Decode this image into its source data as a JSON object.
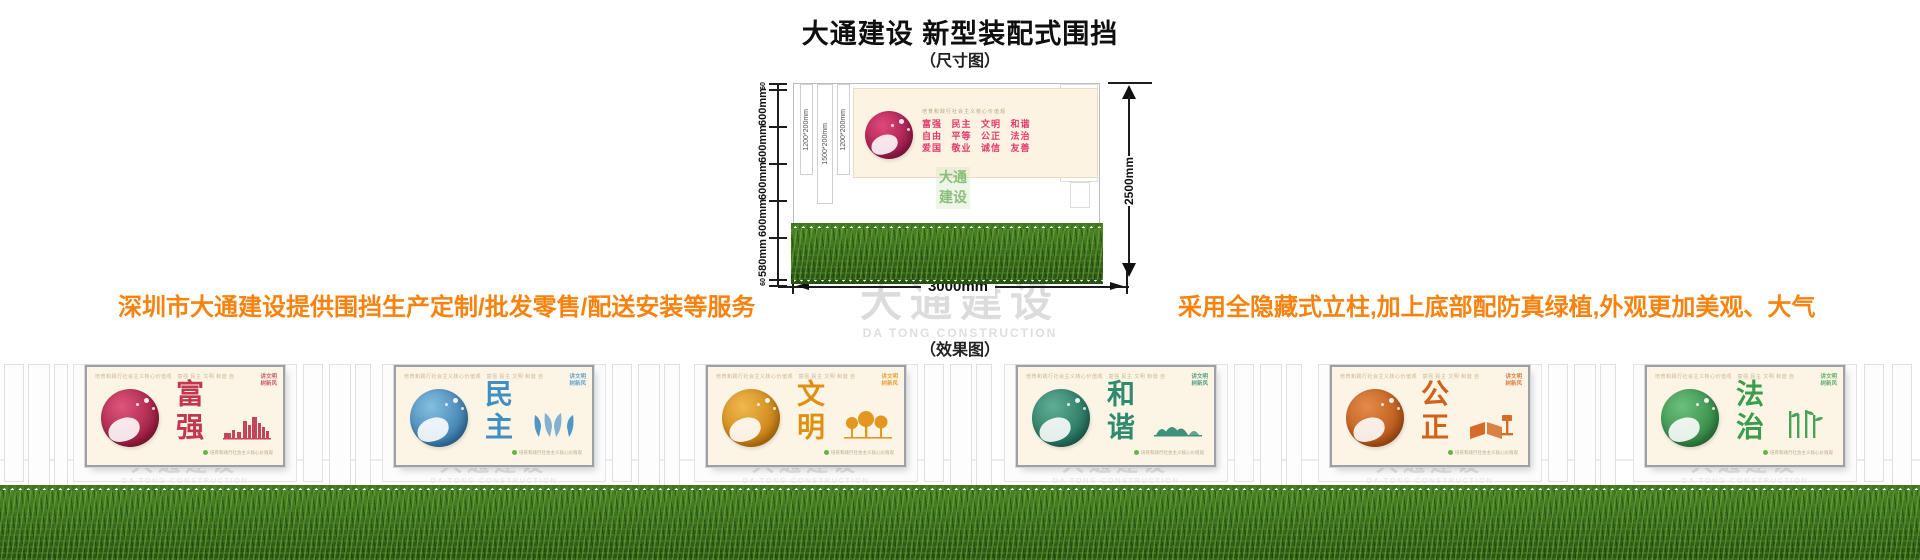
{
  "page": {
    "title": "大通建设 新型装配式围挡",
    "size_label": "（尺寸图）",
    "effect_label": "（效果图）"
  },
  "notes": {
    "left": "深圳市大通建设提供围挡生产定制/批发零售/配送安装等服务",
    "right": "采用全隐藏式立柱,加上底部配防真绿植,外观更加美观、大气",
    "color": "#f8820e"
  },
  "diagram": {
    "post_labels": [
      "1200*200mm",
      "1500*200mm",
      "1200*200mm"
    ],
    "left_dims": [
      "60",
      "600mm",
      "600mm",
      "600mm",
      "600mm",
      "580mm",
      "60"
    ],
    "right_dim": "2500mm",
    "bottom_dim": "3000mm",
    "billboard": {
      "header": "培育和践行社会主义核心价值观",
      "lines": [
        "富强  民主  文明  和谐",
        "自由  平等  公正  法治",
        "爱国  敬业  诚信  友善"
      ],
      "logo_lines": [
        "大通",
        "建设"
      ]
    }
  },
  "watermark": {
    "cn": "大通建设",
    "en": "DA TONG CONSTRUCTION"
  },
  "panel_common": {
    "header": "培育和践行社会主义核心价值观　富强 民主 文明 和谐 自由 平等 公正 法治 爱国 敬业 诚信 友善",
    "corner_lines": [
      "讲文明",
      "树新风"
    ],
    "footer": "培育和践行社会主义核心价值观"
  },
  "panels": [
    {
      "word": "富强",
      "color": "#c2374e",
      "circle1": "#e0557a",
      "circle2": "#8e1034",
      "motif": "city-skyline-bars"
    },
    {
      "word": "民主",
      "color": "#3f8fc4",
      "circle1": "#85bedf",
      "circle2": "#2a6ea3",
      "motif": "doves"
    },
    {
      "word": "文明",
      "color": "#e09010",
      "circle1": "#f0b84e",
      "circle2": "#bf7404",
      "motif": "trees"
    },
    {
      "word": "和谐",
      "color": "#2f8a70",
      "circle1": "#5fae94",
      "circle2": "#176451",
      "motif": "mountains"
    },
    {
      "word": "公正",
      "color": "#d26119",
      "circle1": "#e48b4a",
      "circle2": "#ad4a0b",
      "motif": "book-and-gavel"
    },
    {
      "word": "法治",
      "color": "#3a9c4c",
      "circle1": "#6cc07e",
      "circle2": "#257a36",
      "motif": "bamboo"
    }
  ]
}
